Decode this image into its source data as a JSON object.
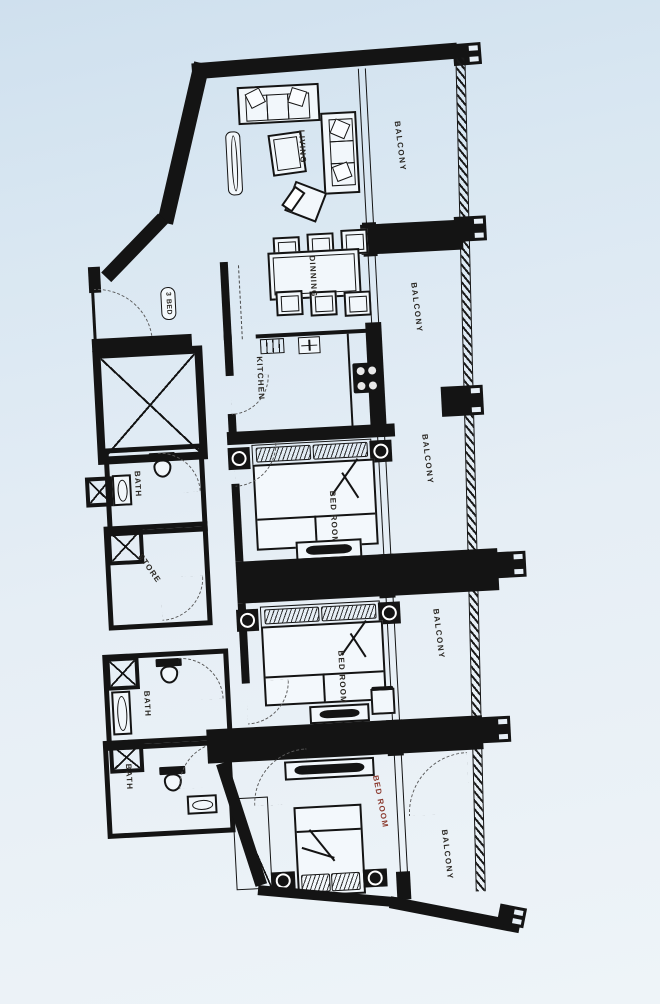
{
  "palette": {
    "ink": "#141414",
    "label_color": "#2a2722",
    "bedroom3_label_color": "#8b3a2e",
    "background_top": "#cfe0ee",
    "background_bottom": "#eef4f8"
  },
  "unit": {
    "badge": "3 BED"
  },
  "rooms": {
    "living": "LIVING",
    "dining": "DINNING",
    "kitchen": "KITCHEN",
    "bedroom_1": "BED ROOM",
    "bedroom_2": "BED ROOM",
    "bedroom_3": "BED ROOM",
    "bath_1": "BATH",
    "bath_2": "BATH",
    "bath_3": "BATH",
    "store": "STORE"
  },
  "balcony": {
    "labels": [
      "BALCONY",
      "BALCONY",
      "BALCONY",
      "BALCONY",
      "BALCONY"
    ]
  }
}
